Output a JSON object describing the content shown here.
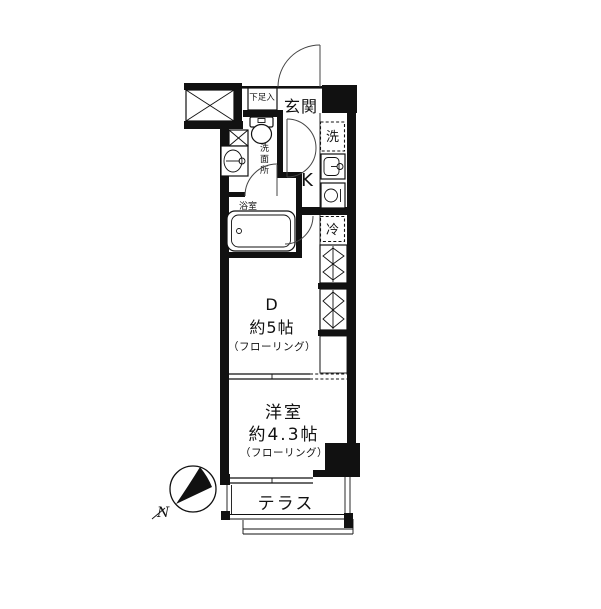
{
  "floorplan": {
    "type": "apartment-floorplan",
    "labels": {
      "genkan": "玄関",
      "shoebox": "下足入",
      "washroom": "洗面所",
      "bathroom": "浴室",
      "washer": "洗",
      "kitchen": "K",
      "fridge": "冷",
      "dining_label": "D",
      "dining_size": "約5帖",
      "dining_floor": "（フローリング）",
      "western_label": "洋室",
      "western_size": "約4.3帖",
      "western_floor": "（フローリング）",
      "terrace": "テラス",
      "compass_north": "N"
    },
    "colors": {
      "wall": "#111111",
      "background": "#ffffff"
    }
  }
}
